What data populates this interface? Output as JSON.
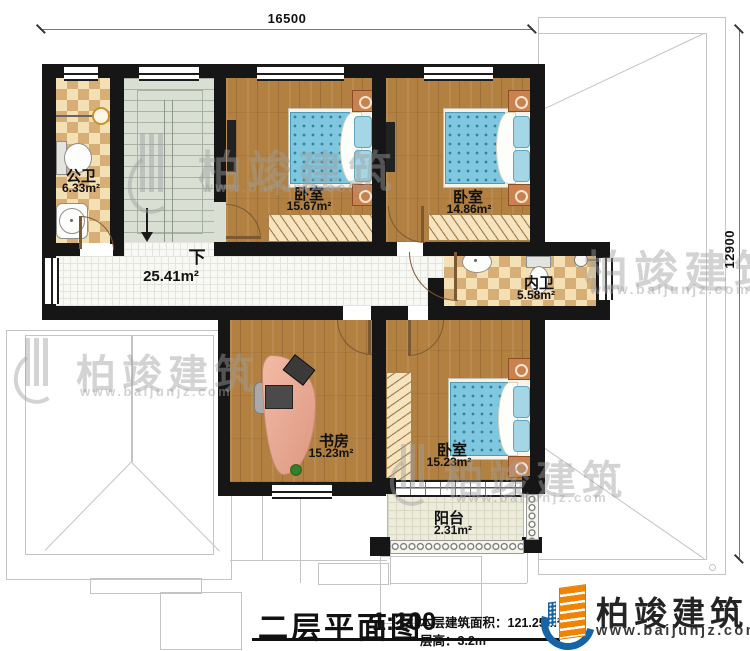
{
  "plan": {
    "dimensions": {
      "width_mm": "16500",
      "height_mm": "12900"
    },
    "stairs_down_label": "下",
    "rooms": [
      {
        "name": "公卫",
        "area": "6.33m²"
      },
      {
        "name": "卧室",
        "area": "15.67m²"
      },
      {
        "name": "卧室",
        "area": "14.86m²"
      },
      {
        "name": "内卫",
        "area": "5.58m²"
      },
      {
        "name": "",
        "area": "25.41m²"
      },
      {
        "name": "书房",
        "area": "15.23m²"
      },
      {
        "name": "卧室",
        "area": "15.23m²"
      },
      {
        "name": "阳台",
        "area": "2.31m²"
      }
    ]
  },
  "title_block": {
    "title": "二层平面图",
    "scale": "1:100",
    "floor_area": "本层建筑面积：121.25m²",
    "floor_height": "层高：3.2m"
  },
  "brand": {
    "name": "柏竣建筑",
    "website": "www.baijunjz.com"
  },
  "watermark": {
    "name": "柏竣建筑",
    "website": "www.baijunjz.com"
  },
  "colors": {
    "wall": "#161616",
    "wood": "#b28040",
    "tile_cream": "#f3e0b4",
    "tile_tan": "#d8ae77",
    "bed_blue": "#7ec7de",
    "desk_salmon": "#e8a68f",
    "brand_blue": "#1464a6",
    "brand_orange": "#f08300"
  }
}
